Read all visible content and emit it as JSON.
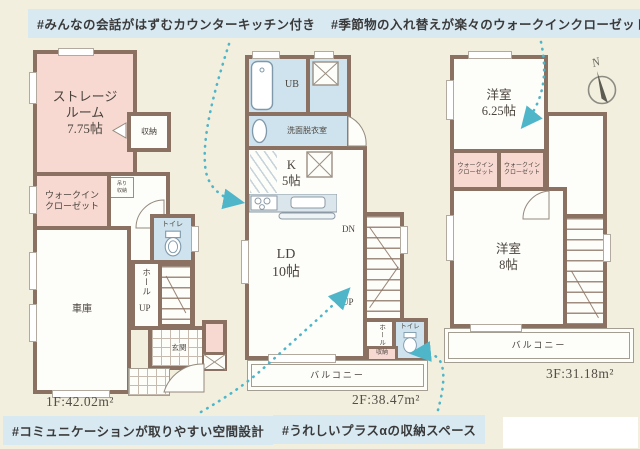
{
  "tags": {
    "top_left": "#みんなの会話がはずむカウンターキッチン付き",
    "top_right": "#季節物の入れ替えが楽々のウォークインクローゼット",
    "bottom_left": "#コミュニケーションが取りやすい空間設計",
    "bottom_right": "#うれしいプラスαの収納スペース"
  },
  "floors": {
    "f1": {
      "area": "1F:42.02m²",
      "rooms": {
        "storage": "ストレージ\nルーム\n7.75帖",
        "closet": "収納",
        "hanging_storage": "吊り\n収納",
        "wic": "ウォークイン\nクローゼット",
        "toilet": "トイレ",
        "hall": "ホール",
        "up": "UP",
        "garage": "車庫",
        "entrance": "玄関"
      }
    },
    "f2": {
      "area": "2F:38.47m²",
      "rooms": {
        "bath": "UB",
        "washroom": "洗面脱衣室",
        "kitchen": "K\n5帖",
        "living": "LD\n10帖",
        "down": "DN",
        "up": "UP",
        "hall": "ホール",
        "toilet": "トイレ",
        "storage": "収納",
        "balcony": "バルコニー"
      }
    },
    "f3": {
      "area": "3F:31.18m²",
      "rooms": {
        "bedroom_625": "洋室\n6.25帖",
        "wic_left": "ウォークイン\nクローゼット",
        "wic_right": "ウォークイン\nクローゼット",
        "bedroom_8": "洋室\n8帖",
        "hall": "ホール",
        "down": "DN",
        "balcony": "バルコニー"
      }
    }
  },
  "compass": {
    "label": "N"
  },
  "colors": {
    "wall": "#8a7161",
    "room_pink": "#f7d9d2",
    "room_blue": "#cfe3ee",
    "background": "#f2efdf",
    "tag_background": "#d8e9f2",
    "arrow_accent": "#4fb6c9"
  }
}
